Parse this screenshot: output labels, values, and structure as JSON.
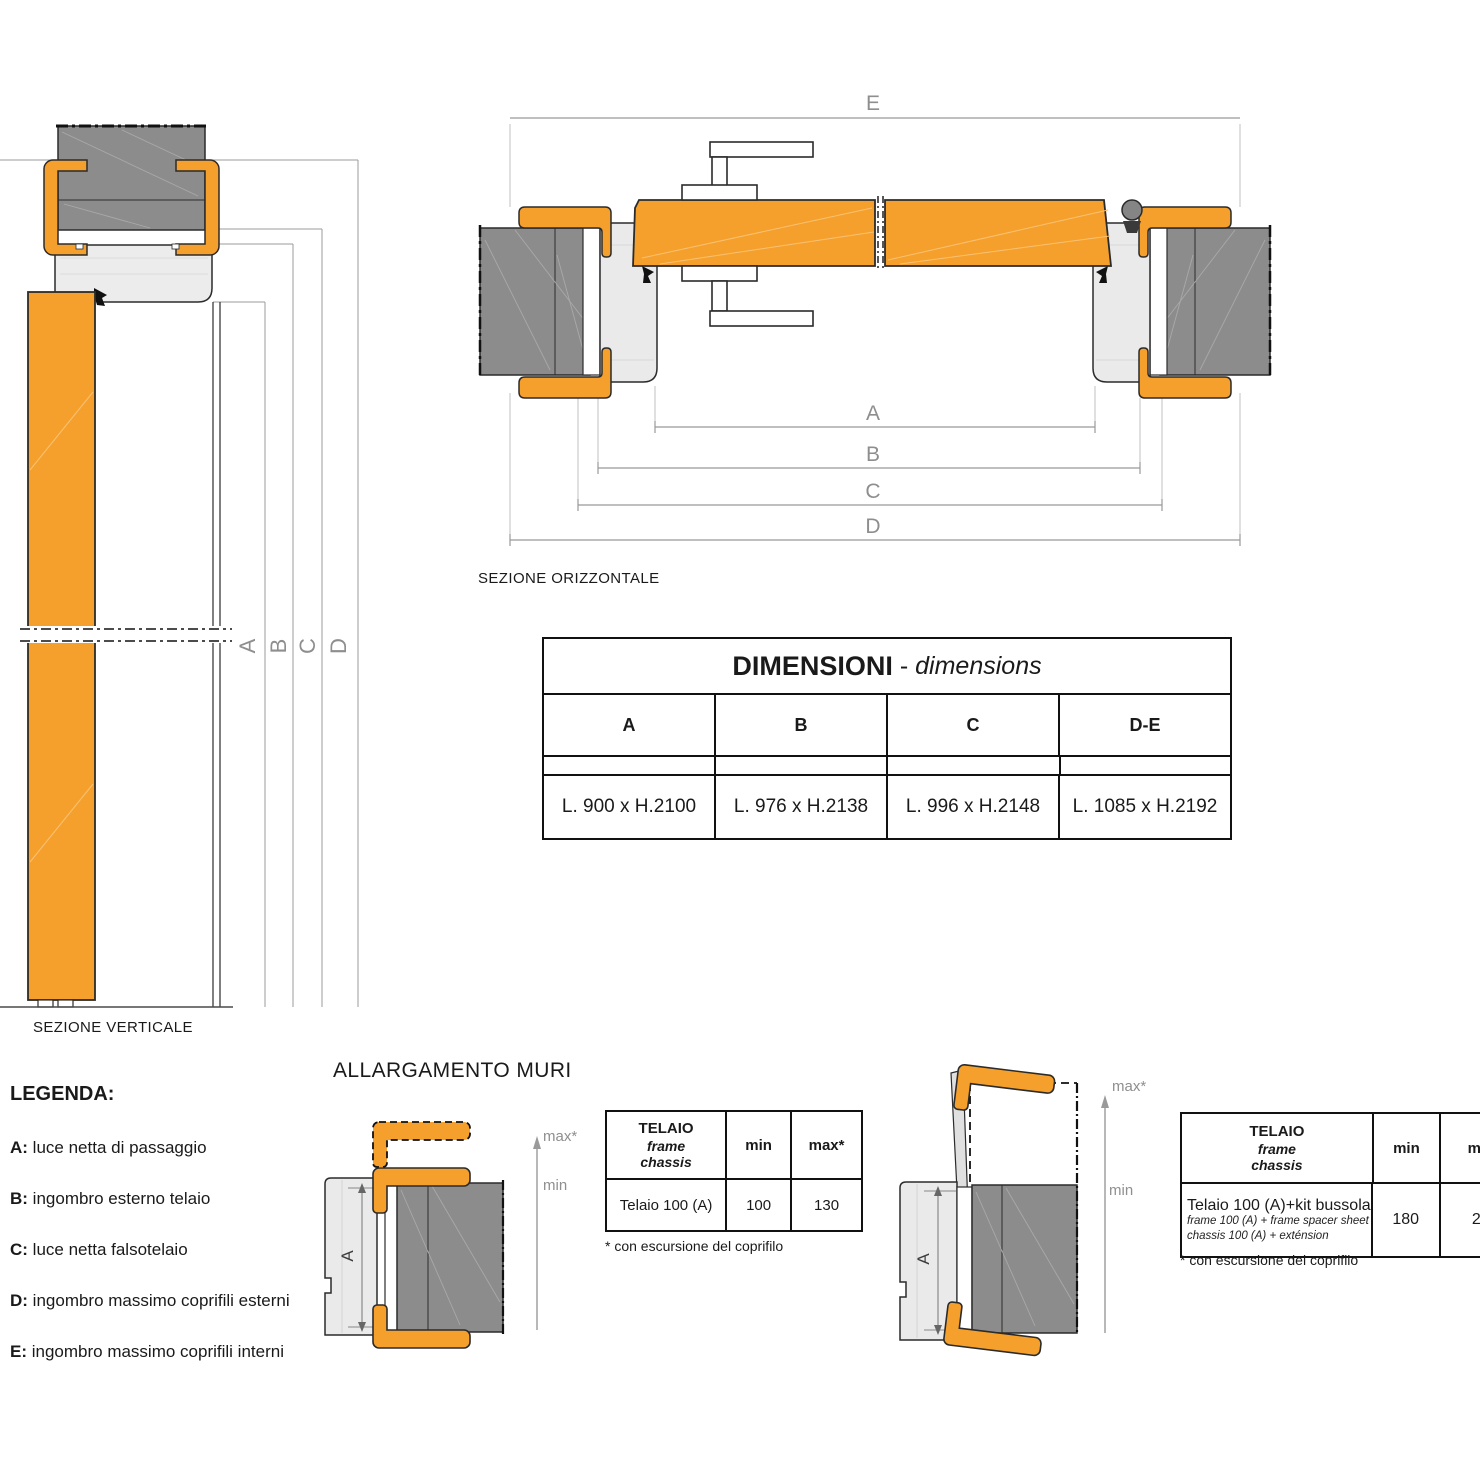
{
  "colors": {
    "orange": "#F5A02C",
    "wall_gray": "#8C8C8C",
    "frame_gray": "#EAEAEA",
    "outline": "#2B2B2B",
    "dim_gray": "#999999",
    "label_gray": "#8E8E8E"
  },
  "vertical_section": {
    "caption": "SEZIONE VERTICALE",
    "dims": [
      "A",
      "B",
      "C",
      "D"
    ]
  },
  "horizontal_section": {
    "caption": "SEZIONE ORIZZONTALE",
    "dim_top": "E",
    "dims": [
      "A",
      "B",
      "C",
      "D"
    ]
  },
  "dimensions_table": {
    "title": "DIMENSIONI",
    "title_sep": " - ",
    "subtitle": "dimensions",
    "columns": [
      "A",
      "B",
      "C",
      "D-E"
    ],
    "values": [
      "L. 900 x H.2100",
      "L. 976 x H.2138",
      "L. 996 x H.2148",
      "L. 1085 x H.2192"
    ]
  },
  "legend": {
    "title": "LEGENDA:",
    "items": [
      {
        "key": "A:",
        "text": " luce netta di passaggio"
      },
      {
        "key": "B:",
        "text": " ingombro esterno telaio"
      },
      {
        "key": "C:",
        "text": " luce netta falsotelaio"
      },
      {
        "key": "D:",
        "text": " ingombro massimo coprifili esterni"
      },
      {
        "key": "E:",
        "text": " ingombro massimo coprifili interni"
      }
    ]
  },
  "allargamento": {
    "title": "ALLARGAMENTO MURI",
    "left": {
      "max_label": "max*",
      "min_label": "min",
      "detail_letter": "A",
      "table": {
        "header_title": [
          "TELAIO",
          "frame",
          "chassis"
        ],
        "col_min": "min",
        "col_max": "max*",
        "row_label": "Telaio 100 (A)",
        "min": "100",
        "max": "130"
      },
      "footnote": "* con escursione del coprifilo"
    },
    "right": {
      "max_label": "max*",
      "min_label": "min",
      "detail_letter": "A",
      "table": {
        "header_title": [
          "TELAIO",
          "frame",
          "chassis"
        ],
        "col_min": "min",
        "col_max": "max*",
        "row_label": "Telaio 100 (A)+kit bussola",
        "row_sub": [
          "frame 100 (A) + frame spacer sheet",
          "chassis 100 (A) + exténsion"
        ],
        "min": "180",
        "max": "200"
      },
      "footnote": "* con escursione del coprifilo"
    }
  }
}
